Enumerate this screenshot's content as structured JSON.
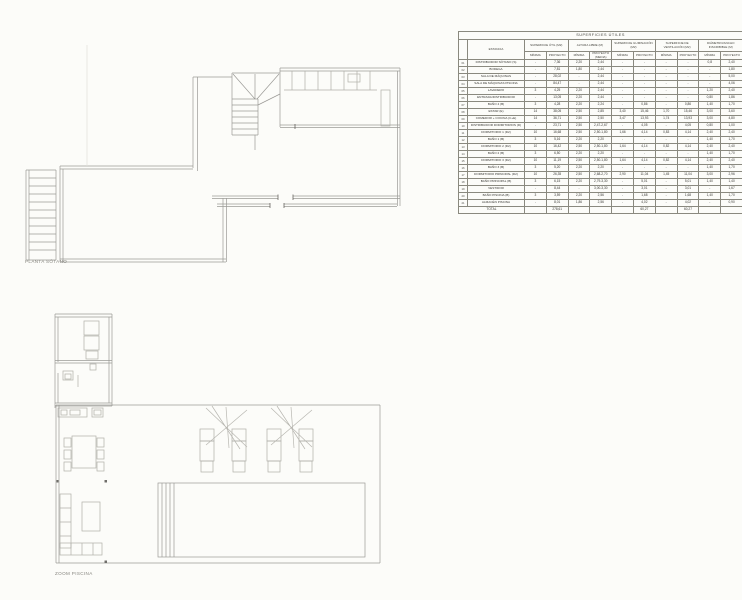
{
  "page": {
    "background": "#fcfcf9",
    "drawing_line_color": "#9b9a96",
    "table_line_color": "#8a897f"
  },
  "plans": [
    {
      "id": "basement",
      "label": "PLANTA SÓTANO"
    },
    {
      "id": "pool-zoom",
      "label": "ZOOM PISCINA"
    }
  ],
  "table": {
    "title": "SUPERFICIES ÚTILES",
    "col_estancia": "ESTANCIA",
    "groups": [
      {
        "label": "SUPERFICIE ÚTIL (M2)",
        "sub": [
          "MÍNIMA",
          "PROYECTO"
        ]
      },
      {
        "label": "ALTURA LIBRE (M)",
        "sub": [
          "MÍNIMA",
          "PROYECTO (MEDIA)"
        ]
      },
      {
        "label": "SUPERFICIE ILUMINACIÓN (M2)",
        "sub": [
          "MÍNIMA",
          "PROYECTO"
        ]
      },
      {
        "label": "SUPERFICIE DE VENTILACIÓN (M2)",
        "sub": [
          "MÍNIMA",
          "PROYECTO"
        ]
      },
      {
        "label": "DIÁMETRO/ANCHO INSCRIBIBLE (M)",
        "sub": [
          "MÍNIMA",
          "PROYECTO"
        ]
      }
    ],
    "rows": [
      {
        "num": "01",
        "name": "DISTRIBUIDOR SÓTANO (S)",
        "values": [
          "-",
          "7,36",
          "2,20",
          "2,44",
          "-",
          "-",
          "-",
          "-",
          "0,8",
          "2,40"
        ]
      },
      {
        "num": "02",
        "name": "BODEGA",
        "values": [
          "-",
          "7,81",
          "1,80",
          "2,44",
          "-",
          "-",
          "-",
          "-",
          "-",
          "1,80"
        ]
      },
      {
        "num": "03",
        "name": "SALA DE MÁQUINAS",
        "values": [
          "-",
          "28,02",
          "-",
          "2,44",
          "-",
          "-",
          "-",
          "-",
          "-",
          "5,00"
        ]
      },
      {
        "num": "04",
        "name": "SALA DE MÁQUINAS PISCINA",
        "values": [
          "-",
          "84,47",
          "-",
          "2,44",
          "-",
          "-",
          "-",
          "-",
          "-",
          "4,06"
        ]
      },
      {
        "num": "05",
        "name": "LAVADERO",
        "values": [
          "3",
          "4,25",
          "2,20",
          "2,44",
          "-",
          "-",
          "-",
          "-",
          "1,20",
          "2,40"
        ]
      },
      {
        "num": "06",
        "name": "ENTRADA/DISTRIBUIDOR",
        "values": [
          "-",
          "13,05",
          "2,20",
          "2,44",
          "-",
          "-",
          "-",
          "-",
          "0,80",
          "1,86"
        ]
      },
      {
        "num": "07",
        "name": "BAÑO 4 (B)",
        "values": [
          "3",
          "4,28",
          "2,20",
          "2,24",
          "-",
          "0,86",
          "-",
          "0,86",
          "1,40",
          "1,70"
        ]
      },
      {
        "num": "08",
        "name": "ESTAR (E)",
        "values": [
          "14",
          "38,05",
          "2,50",
          "2,85",
          "3,40",
          "15,46",
          "1,70",
          "15,46",
          "3,00",
          "3,60"
        ]
      },
      {
        "num": "09",
        "name": "COMEDOR + COCINA (C+E)",
        "values": [
          "14",
          "36,71",
          "2,50",
          "2,50",
          "3,47",
          "13,93",
          "1,74",
          "13,93",
          "3,00",
          "4,80"
        ]
      },
      {
        "num": "10",
        "name": "DISTRIBUIDOR DORMITORIOS (D)",
        "values": [
          "-",
          "23,71",
          "2,50",
          "2,47-2,67",
          "-",
          "4,05",
          "-",
          "4,05",
          "0,80",
          "1,00"
        ]
      },
      {
        "num": "11",
        "name": "DORMITORIO 1 (D2)",
        "values": [
          "10",
          "16,68",
          "2,50",
          "2,50-1,80",
          "1,66",
          "4,14",
          "0,83",
          "4,14",
          "2,40",
          "2,40"
        ]
      },
      {
        "num": "12",
        "name": "BAÑO 1 (B)",
        "values": [
          "3",
          "5,16",
          "2,20",
          "2,20",
          "-",
          "-",
          "-",
          "-",
          "1,40",
          "1,70"
        ]
      },
      {
        "num": "13",
        "name": "DORMITORIO 2 (D2)",
        "values": [
          "10",
          "16,42",
          "2,50",
          "2,50-1,80",
          "1,64",
          "4,14",
          "0,82",
          "4,14",
          "2,40",
          "2,40"
        ]
      },
      {
        "num": "14",
        "name": "BAÑO 2 (B)",
        "values": [
          "3",
          "6,50",
          "2,20",
          "2,20",
          "-",
          "-",
          "-",
          "-",
          "1,40",
          "1,70"
        ]
      },
      {
        "num": "15",
        "name": "DORMITORIO 3 (D2)",
        "values": [
          "10",
          "11,19",
          "2,50",
          "2,50-1,80",
          "1,64",
          "4,14",
          "0,82",
          "4,14",
          "2,40",
          "2,40"
        ]
      },
      {
        "num": "16",
        "name": "BAÑO 3 (B)",
        "values": [
          "3",
          "5,20",
          "2,20",
          "2,20",
          "-",
          "-",
          "-",
          "-",
          "1,40",
          "1,70"
        ]
      },
      {
        "num": "17",
        "name": "DORMITORIO PRINCIPAL (D2)",
        "values": [
          "10",
          "26,35",
          "2,50",
          "2,68-2,70",
          "2,90",
          "11,04",
          "1,45",
          "11,04",
          "3,00",
          "2,96"
        ]
      },
      {
        "num": "18",
        "name": "BAÑO PRINCIPAL (B)",
        "values": [
          "3",
          "6,15",
          "2,20",
          "2,79-3,30",
          "-",
          "5,01",
          "-",
          "5,01",
          "1,40",
          "1,40"
        ]
      },
      {
        "num": "19",
        "name": "VESTIDOR",
        "values": [
          "-",
          "8,44",
          "-",
          "3,00-3,30",
          "-",
          "3,01",
          "-",
          "3,01",
          "-",
          "1,67"
        ]
      },
      {
        "num": "20",
        "name": "BAÑO PISCINA (B)",
        "values": [
          "3",
          "3,59",
          "2,20",
          "2,56",
          "-",
          "1,68",
          "-",
          "1,68",
          "1,40",
          "1,70"
        ]
      },
      {
        "num": "21",
        "name": "ALMACÉN PISCINA",
        "values": [
          "-",
          "8,01",
          "1,86",
          "2,56",
          "-",
          "4,02",
          "-",
          "4,02",
          "-",
          "0,90"
        ]
      }
    ],
    "total": {
      "label": "TOTAL",
      "values": [
        "",
        "278,61",
        "",
        "",
        "",
        "60,27",
        "",
        "60,27",
        "",
        ""
      ]
    }
  }
}
